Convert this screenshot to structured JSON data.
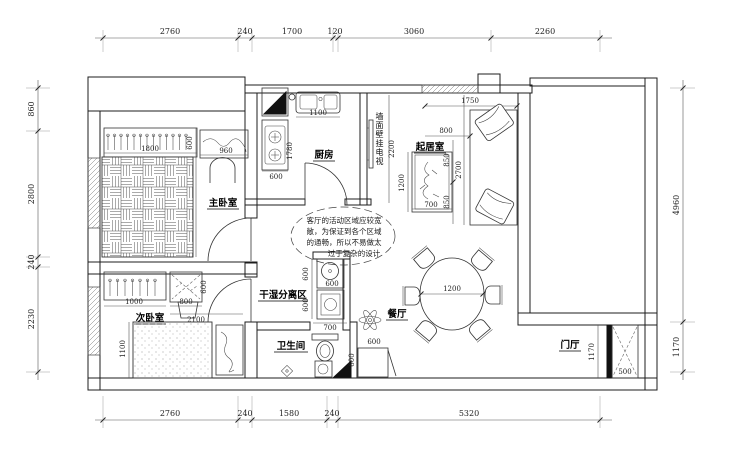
{
  "colors": {
    "wall": "#1c1c1c",
    "dim": "#3d3d3d",
    "light": "#9a9a9a",
    "bg": "#ffffff"
  },
  "rooms": {
    "master_bedroom": "主卧室",
    "second_bedroom": "次卧室",
    "kitchen": "厨房",
    "living_room": "起居室",
    "dining_room": "餐厅",
    "dry_wet_zone": "干湿分离区",
    "bathroom": "卫生间",
    "entry_hall": "门厅",
    "tv_wall_note": "墙面壁挂电视"
  },
  "annotation": {
    "line1": "客厅的活动区域应较宽",
    "line2": "敞，为保证到各个区域",
    "line3": "的通畅，所以不易做太",
    "line4": "过于复杂的设计"
  },
  "dims": {
    "top": {
      "d1": "2760",
      "d2": "240",
      "d3": "1700",
      "d4": "120",
      "d5": "3060",
      "d6": "2260"
    },
    "bottom": {
      "d1": "2760",
      "d2": "240",
      "d3": "1580",
      "d4": "240",
      "d5": "5320"
    },
    "left": {
      "d1": "860",
      "d2": "2800",
      "d3": "240",
      "d4": "2230"
    },
    "right": {
      "d1": "4960",
      "d2": "1170"
    },
    "master": {
      "wardrobe_w": "1800",
      "wardrobe_d": "600",
      "vanity_w": "960",
      "bed_l": "2200"
    },
    "kitchen": {
      "sink_w": "1100",
      "counter_l": "1780",
      "counter_w": "600"
    },
    "tv_wall_h": "2200",
    "living": {
      "bay_w": "1750",
      "sofa_d": "800",
      "seat_a": "850",
      "seat_b": "850",
      "sofa_l": "2700",
      "table_l": "1200",
      "table_w": "700"
    },
    "second": {
      "wardrobe_w": "1000",
      "desk_w": "800",
      "desk_d": "600",
      "room_w": "2100",
      "bed_w": "1100"
    },
    "wet": {
      "basin_d": "600",
      "basin_w": "600",
      "washer_w": "600",
      "zone_w": "700"
    },
    "bath": {
      "cabinet_d": "600",
      "cabinet_w": "600"
    },
    "dining": {
      "table_dia": "1200"
    },
    "entry": {
      "cabinet_h": "1170",
      "cabinet_w": "500"
    }
  }
}
